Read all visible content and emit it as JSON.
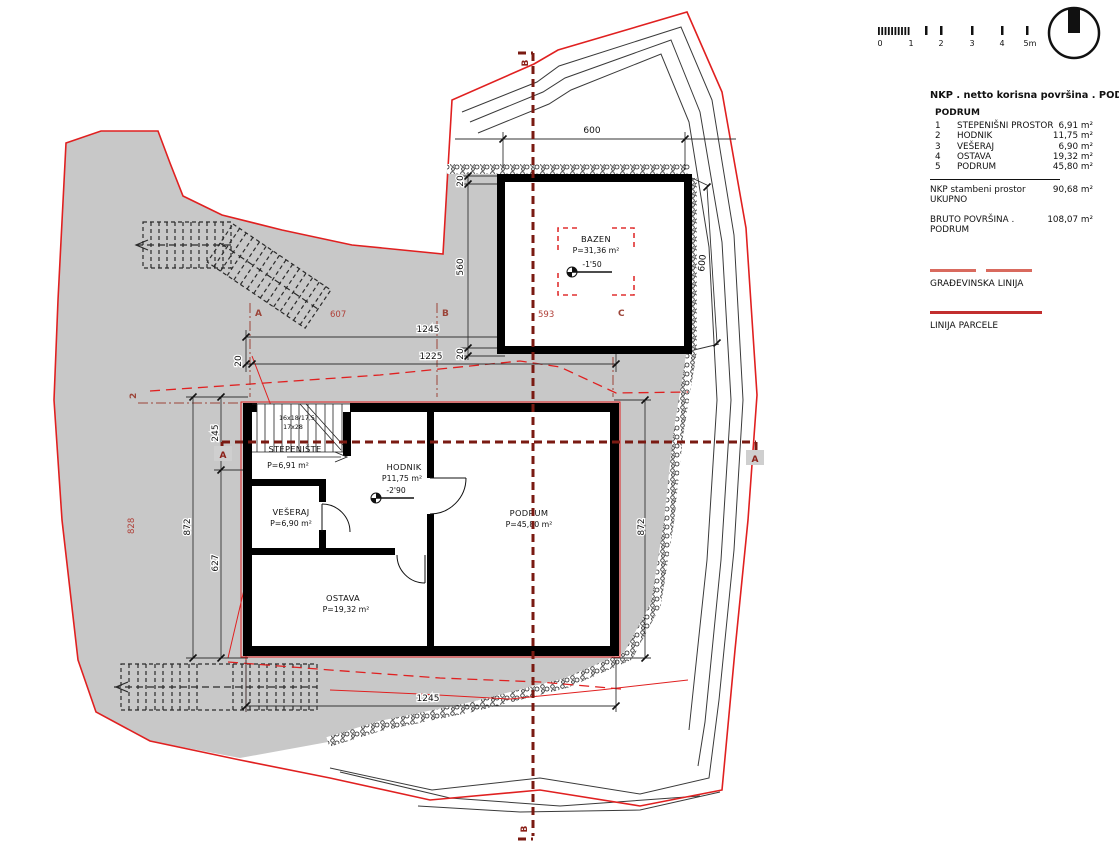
{
  "title_block": {
    "title": "NKP . netto korisna površina . PODRUM",
    "group": "PODRUM",
    "rows": [
      {
        "num": "1",
        "name": "STEPENIŠNI PROSTOR",
        "value": "6,91 m²"
      },
      {
        "num": "2",
        "name": "HODNIK",
        "value": "11,75 m²"
      },
      {
        "num": "3",
        "name": "VEŠERAJ",
        "value": "6,90 m²"
      },
      {
        "num": "4",
        "name": "OSTAVA",
        "value": "19,32 m²"
      },
      {
        "num": "5",
        "name": "PODRUM",
        "value": "45,80 m²"
      }
    ],
    "total_label": "NKP stambeni prostor UKUPNO",
    "total_value": "90,68 m²",
    "bruto_label": "BRUTO POVRŠINA . PODRUM",
    "bruto_value": "108,07 m²",
    "legend_building_line": "GRAĐEVINSKA LINIJA",
    "legend_parcel_line": "LINIJA PARCELE"
  },
  "scale_bar": {
    "labels": [
      "0",
      "1",
      "2",
      "3",
      "4",
      "5m"
    ]
  },
  "rooms": {
    "bazen": {
      "name": "BAZEN",
      "area": "P=31,36 m²",
      "level": "-1'50"
    },
    "stepeniste": {
      "name": "STEPENIŠTE",
      "area": "P=6,91 m²"
    },
    "hodnik": {
      "name": "HODNIK",
      "area": "P11,75 m²",
      "level": "-2'90"
    },
    "veseraj": {
      "name": "VEŠERAJ",
      "area": "P=6,90 m²"
    },
    "ostava": {
      "name": "OSTAVA",
      "area": "P=19,32 m²"
    },
    "podrum": {
      "name": "PODRUM",
      "area": "P=45,80 m²"
    }
  },
  "stairs": {
    "note1": "16x18/17,5",
    "note2": "17x28"
  },
  "dims": {
    "top_600": "600",
    "right_600": "600",
    "w1245": "1245",
    "w1225": "1225",
    "bottom_1245": "1245",
    "wall20a": "20",
    "wall20b": "20",
    "wall20c": "20",
    "pool_560": "560",
    "left_245": "245",
    "left_872": "872",
    "left_627": "627",
    "right_872": "872"
  },
  "grid": {
    "a": "A",
    "b": "B",
    "c": "C",
    "axis2": "2"
  },
  "site_dims": {
    "d607": "607",
    "d593": "593",
    "d828": "828"
  },
  "sections": {
    "a": "A",
    "b": "B"
  },
  "colors": {
    "terrain_grey": "#c8c8c8",
    "parcel_red": "#e02020",
    "section_maroon": "#7a1a12",
    "grid_brown": "#9c4438",
    "wall_black": "#000000"
  }
}
